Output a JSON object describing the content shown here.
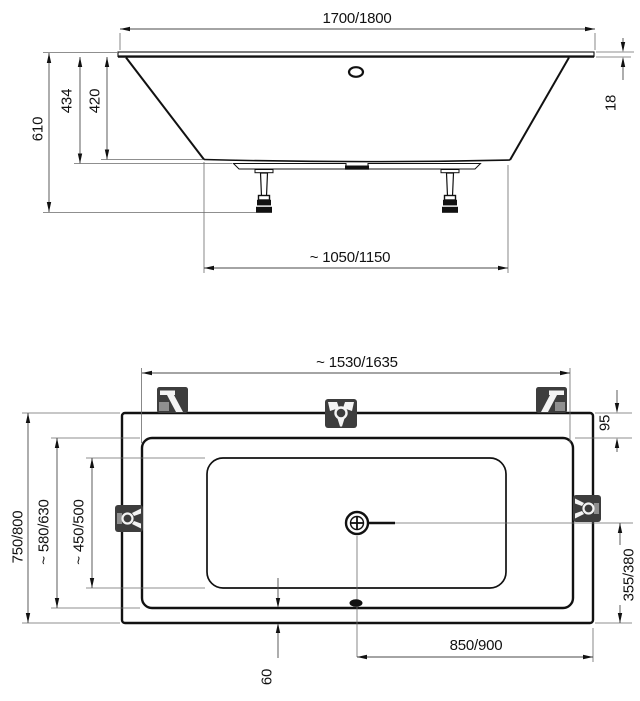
{
  "drawing": {
    "subject": "Bathtub technical dimension drawing, side elevation and plan view",
    "side_view": {
      "dims": {
        "overall_length": "1700/1800",
        "overall_height": "610",
        "height_to_frame": "434",
        "height_to_shell": "420",
        "rim_thickness": "18",
        "support_base_length": "~ 1050/1150"
      },
      "icons": [
        "overflow-oval",
        "support-leg",
        "support-rail"
      ]
    },
    "plan_view": {
      "dims": {
        "inner_rim_length": "~ 1530/1635",
        "head_rim_width": "95",
        "overall_width": "750/800",
        "inner_rim_width": "~ 580/630",
        "floor_width": "~ 450/500",
        "drain_offset_side": "355/380",
        "drain_offset_end": "850/900",
        "front_rim_width": "60"
      },
      "icons": [
        "drain-icon",
        "waste-oval",
        "mounting-bracket"
      ]
    },
    "colors": {
      "object_line": "#111111",
      "dim_line": "#4a4a4a",
      "bracket_fill": "#3d3d3d",
      "background": "#ffffff"
    }
  }
}
